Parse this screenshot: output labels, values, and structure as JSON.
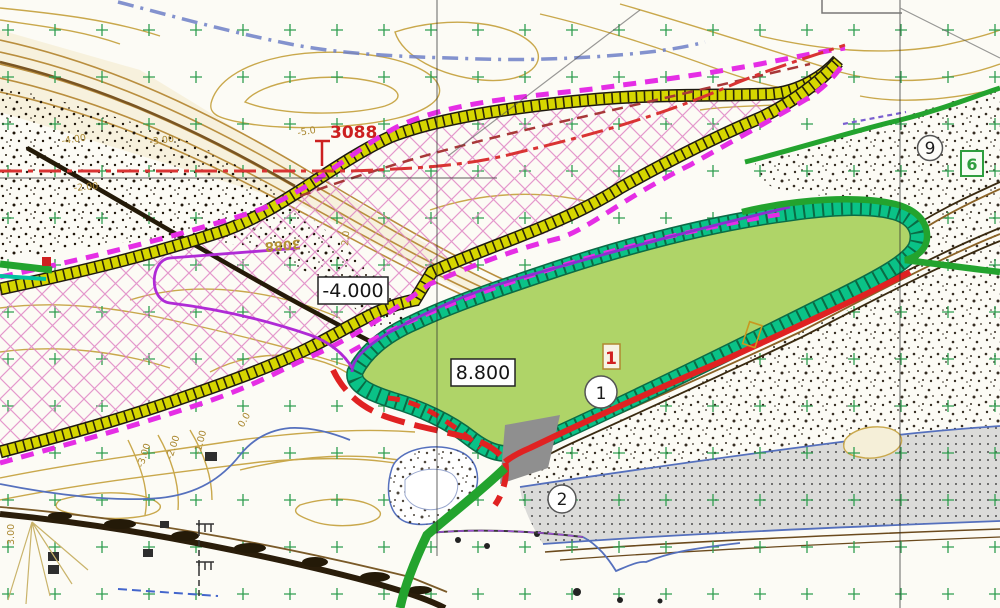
{
  "boxed_labels": {
    "dredge": "-4.000",
    "fill": "8.800"
  },
  "station_marks": {
    "red_km": "3088",
    "tan_km": "3088"
  },
  "point_markers": {
    "circle_1": "1",
    "circle_2": "2",
    "circle_9": "9",
    "red_box": "1",
    "green_box": "6"
  },
  "contour_labels": [
    "-4.00",
    "-3.00",
    "-2.00",
    "-3.00",
    "-2.00",
    "-1.00",
    "0.0",
    "-5.0",
    "2.0",
    "3.00"
  ],
  "colors": {
    "reclamation_fill": "#afd468",
    "embankment_teal": "#0ac287",
    "dike_yellow": "#d6d600",
    "boundary_magenta": "#e52ee5",
    "toe_line_purple": "#8c2fd0",
    "works_red": "#e02222",
    "channel_axis_red": "#d93333",
    "water_blue": "#5570bd",
    "upper_channel_blue": "#6d7fc7",
    "contour_tan": "#c9a84c",
    "grid_cross_green": "#2f9e4f",
    "riverbed_gray": "#dbdbd9",
    "road_brown": "#6b4a1d"
  }
}
